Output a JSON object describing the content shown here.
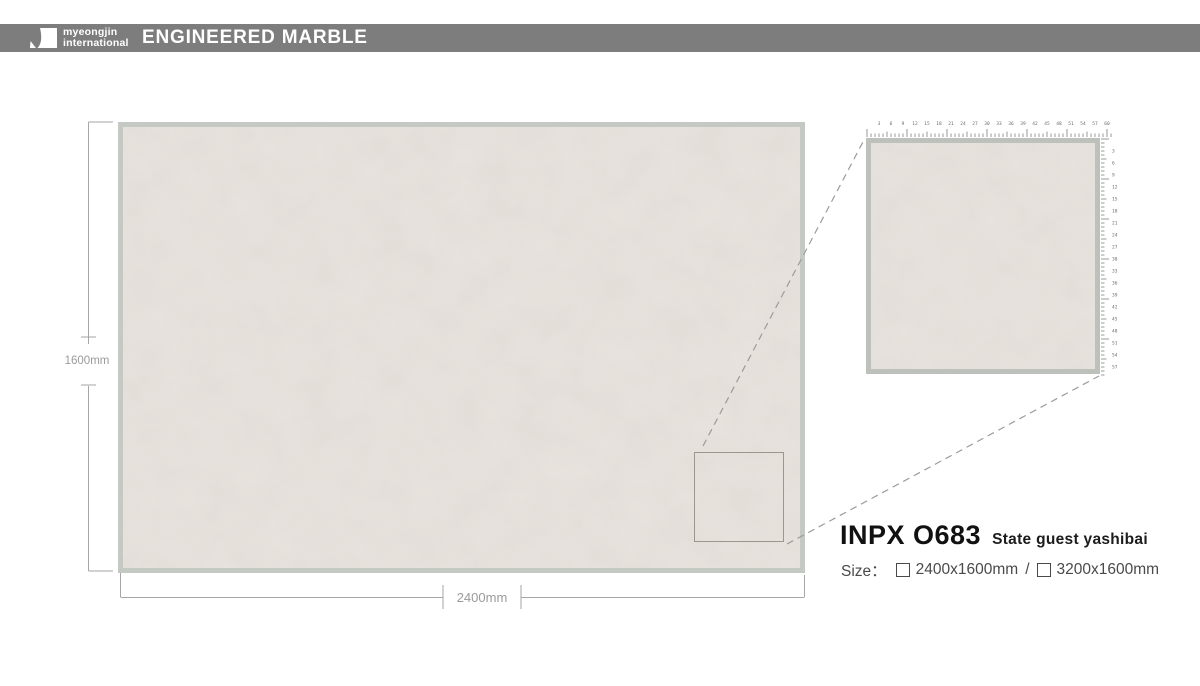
{
  "header": {
    "brand_line1": "myeongjin",
    "brand_line2": "international",
    "title": "ENGINEERED MARBLE"
  },
  "slab": {
    "height_label": "1600mm",
    "width_label": "2400mm"
  },
  "product": {
    "code": "INPX O683",
    "name": "State guest yashibai",
    "size_label": "Size：",
    "separator": "/",
    "size_options": [
      {
        "label": "2400x1600mm",
        "checked": false
      },
      {
        "label": "3200x1600mm",
        "checked": false
      }
    ]
  },
  "colors": {
    "header_bg": "#7d7d7d",
    "slab_border": "#c5c9c4",
    "detail_border": "#bcc1bc",
    "marble_base": "#e8e3de",
    "dimension_gray": "#9a9a9a",
    "text_dark": "#111111"
  },
  "detail_rulers": {
    "top": {
      "ticks": 61,
      "spacing": 4,
      "minor_len": 3.5,
      "mid_len": 5.5,
      "major_len": 8,
      "number_every": 3,
      "font_size": 4.5
    },
    "right": {
      "ticks": 59,
      "spacing": 4,
      "minor_len": 3.5,
      "mid_len": 5.5,
      "major_len": 8,
      "number_every": 3,
      "font_size": 4.5
    }
  }
}
